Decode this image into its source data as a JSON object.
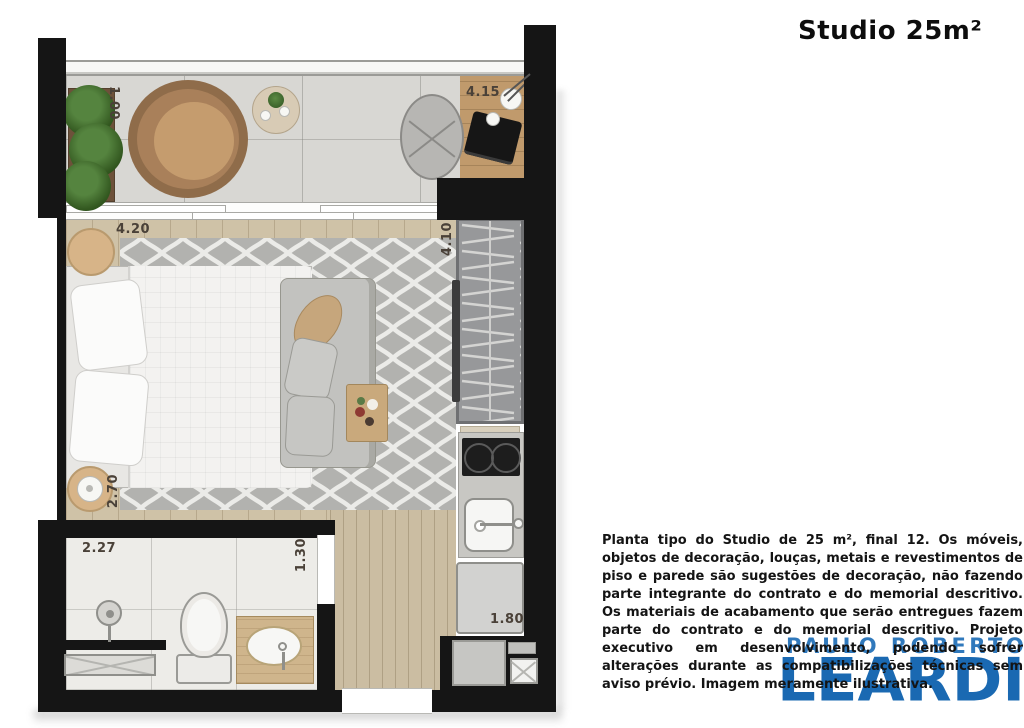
{
  "header": {
    "title": "Studio 25m²"
  },
  "floorplan": {
    "dimensions": {
      "balcony_depth": "1.00",
      "balcony_length": "4.15",
      "bedroom_length": "4.20",
      "closet_wall_length": "4.10",
      "bedroom_width": "2.70",
      "bathroom_length": "2.27",
      "bathroom_width": "1.30",
      "kitchen_width": "1.80"
    }
  },
  "disclaimer": {
    "text": "Planta tipo do Studio de 25 m², final 12. Os móveis, objetos de decoração, louças, metais e revestimentos de piso e parede são sugestões de decoração, não fazendo parte integrante do contrato e do memorial descritivo. Os materiais de acabamento que serão entregues fazem parte do contrato e do memorial descritivo. Projeto executivo em desenvolvimento, podendo sofrer alterações durante as compatibilizações técnicas sem aviso prévio. Imagem meramente ilustrativa."
  },
  "logo": {
    "top_line": "PAULO ROBERTO",
    "name": "LEARDI"
  },
  "colors": {
    "wall": "#151515",
    "logo_top_blue": "#3079bc",
    "logo_main_blue": "#1a69b2",
    "dimension_text": "#4a4138",
    "rug_gray": "#b2b2af",
    "rug_pattern": "#ebebe8"
  }
}
